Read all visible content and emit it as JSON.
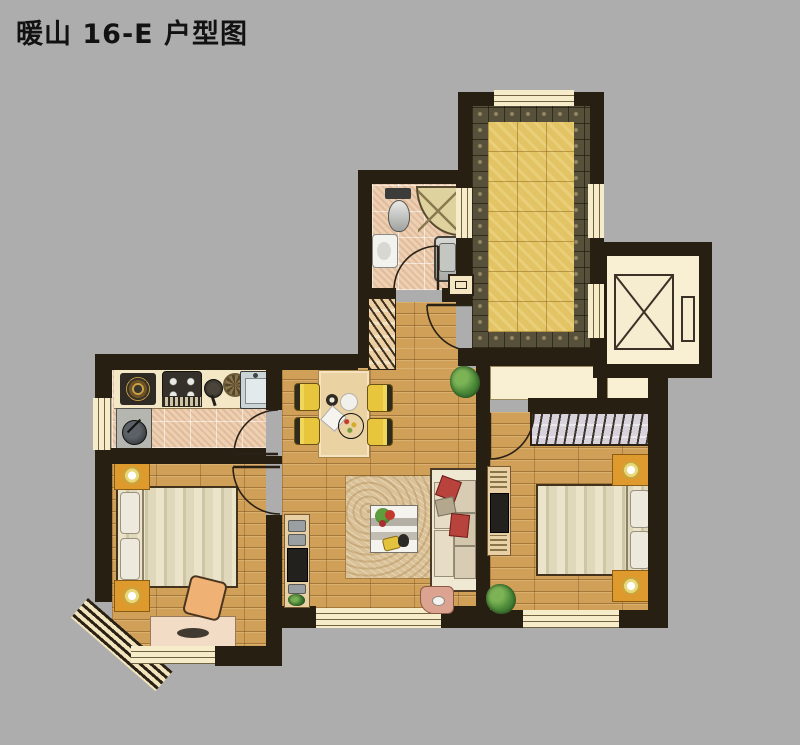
{
  "page": {
    "title": "暖山 16-E 户型图",
    "background": "#adadad"
  },
  "palette": {
    "wall": "#281f13",
    "wood_floor": "#d0a058",
    "gold_tile": "#e3c464",
    "mosaic_border": "#57503a",
    "bath_tile": "#ecd0b2",
    "window_cream": "#f7ecca",
    "elevator_cream": "#f9efd3",
    "nightstand_orange": "#df9a2d",
    "chair_yellow": "#e7c63e",
    "sofa_cream": "#efe8d3",
    "pillow_red": "#b8433d",
    "plant_green": "#3f7a33",
    "rug_beige": "#d9c199",
    "side_table_pink": "#dba390"
  },
  "rooms": [
    {
      "name": "corridor-terrace"
    },
    {
      "name": "elevator-shaft"
    },
    {
      "name": "bathroom"
    },
    {
      "name": "entry-hall"
    },
    {
      "name": "kitchen"
    },
    {
      "name": "dining-area"
    },
    {
      "name": "living-room"
    },
    {
      "name": "bedroom-left"
    },
    {
      "name": "bedroom-right"
    }
  ]
}
